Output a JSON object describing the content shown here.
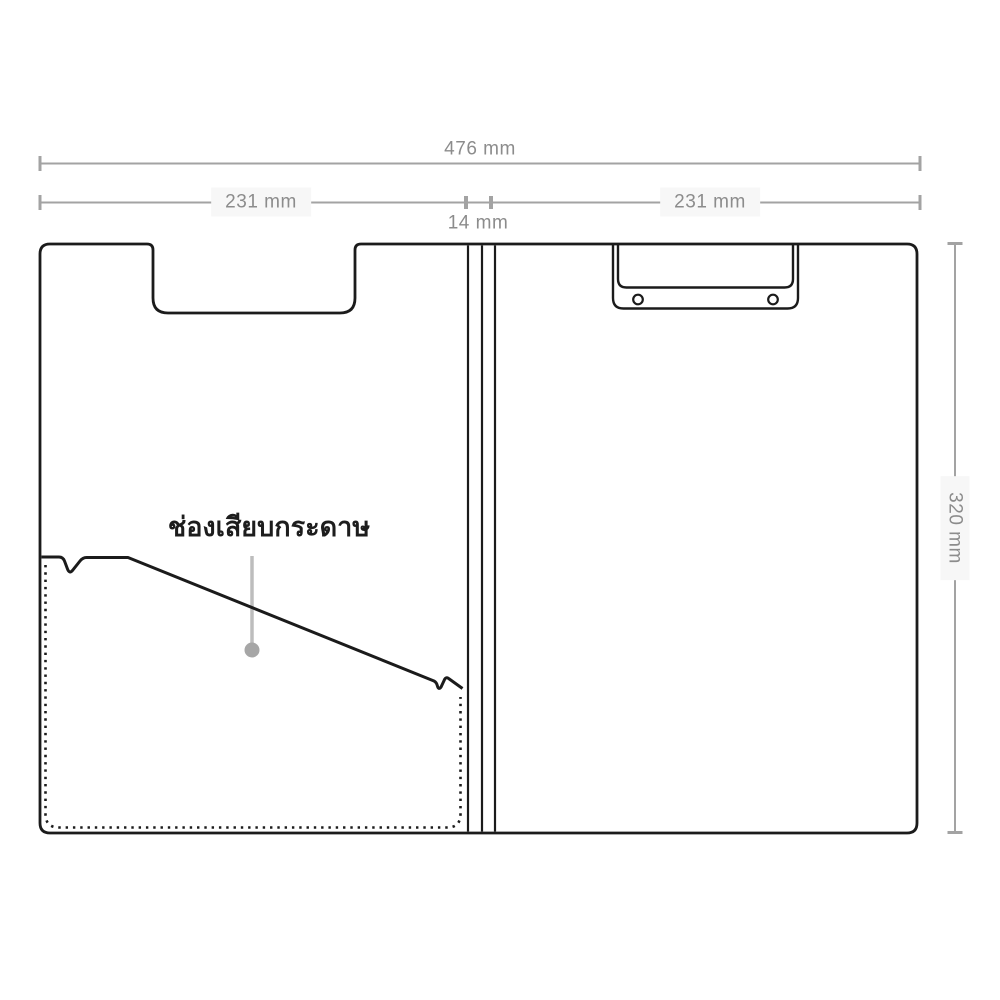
{
  "diagram": {
    "subject": "folding-clipboard-dimension-drawing",
    "labels": {
      "total_width": "476 mm",
      "left_panel_width": "231 mm",
      "spine_width": "14 mm",
      "right_panel_width": "231 mm",
      "height": "320 mm",
      "pocket_annotation": "ช่องเสียบกระดาษ"
    },
    "colors": {
      "outline": "#1b1b1b",
      "dimension": "#a3a3a3",
      "dimension_text": "#8c8c8c",
      "leader": "#bdbdbd",
      "leader_dot": "#a6a6a6",
      "label_bg": "#f7f7f7",
      "annotation_text": "#1d1d1d",
      "background": "#ffffff"
    }
  }
}
